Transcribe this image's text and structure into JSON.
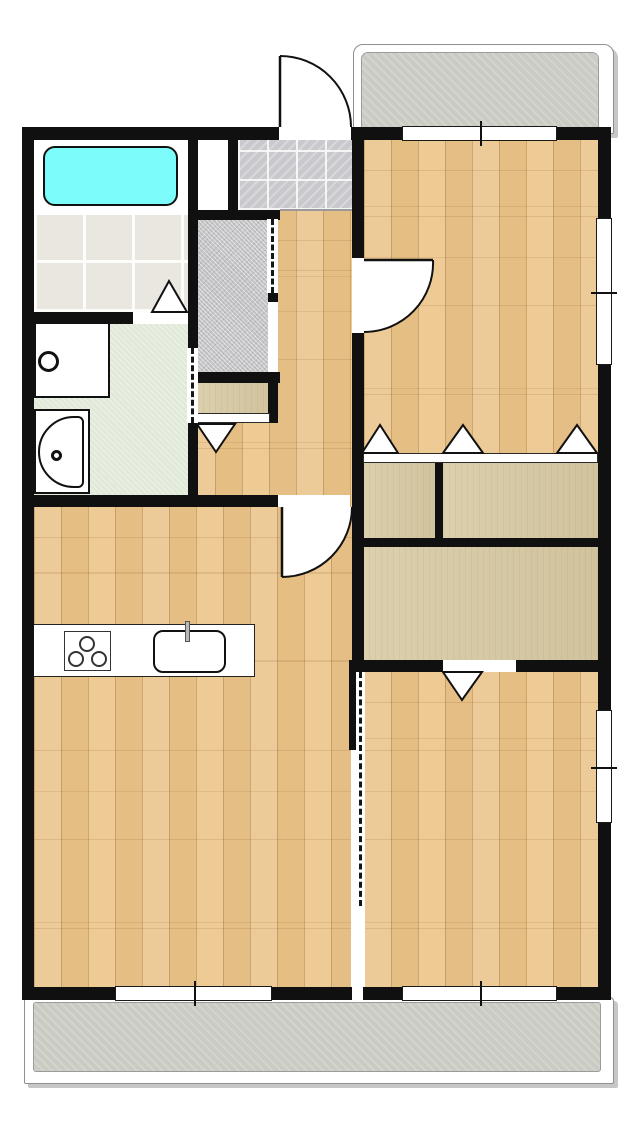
{
  "canvas": {
    "width": 639,
    "height": 1127,
    "background": "#ffffff"
  },
  "palette": {
    "wall": "#101010",
    "wood": "#ebc58c",
    "closet": "#d7c9a2",
    "tileBath": "#e9e7e0",
    "genkan": "#c8c8cd",
    "sic": "#c5c4c7",
    "washroom": "#e1e9d9",
    "balcony": "#caccc3",
    "tub": "#7dfcfc"
  },
  "surfaces": [
    {
      "name": "balcony-north-outer",
      "kind": "balcony-outer",
      "x": 353,
      "y": 44,
      "w": 259,
      "h": 88,
      "r": 10
    },
    {
      "name": "balcony-north-floor",
      "kind": "balcony",
      "x": 362,
      "y": 53,
      "w": 236,
      "h": 75,
      "r": 6
    },
    {
      "name": "balcony-south-outer",
      "kind": "balcony-outer",
      "x": 24,
      "y": 997,
      "w": 588,
      "h": 85,
      "r": 4
    },
    {
      "name": "balcony-south-floor",
      "kind": "balcony",
      "x": 34,
      "y": 1003,
      "w": 566,
      "h": 68,
      "r": 2
    },
    {
      "name": "hallway-floor",
      "kind": "wood",
      "x": 188,
      "y": 210,
      "w": 164,
      "h": 297
    },
    {
      "name": "living-dining-kitchen-floor",
      "kind": "wood",
      "x": 34,
      "y": 507,
      "w": 318,
      "h": 480
    },
    {
      "name": "bedroom-north-floor",
      "kind": "wood",
      "x": 364,
      "y": 140,
      "w": 234,
      "h": 313
    },
    {
      "name": "bedroom-south-floor",
      "kind": "wood",
      "x": 364,
      "y": 672,
      "w": 234,
      "h": 315
    },
    {
      "name": "bathroom-floor",
      "kind": "white",
      "x": 34,
      "y": 140,
      "w": 154,
      "h": 75
    },
    {
      "name": "bathroom-tile-floor",
      "kind": "tile-bath",
      "x": 34,
      "y": 215,
      "w": 154,
      "h": 97
    },
    {
      "name": "utility-void",
      "kind": "white",
      "x": 198,
      "y": 137,
      "w": 30,
      "h": 76
    },
    {
      "name": "entry-tile-floor",
      "kind": "tile-genkan",
      "x": 238,
      "y": 140,
      "w": 114,
      "h": 70
    },
    {
      "name": "shoe-closet-floor",
      "kind": "sic",
      "x": 197,
      "y": 219,
      "w": 71,
      "h": 153
    },
    {
      "name": "hall-closet-shelf",
      "kind": "closet",
      "x": 197,
      "y": 380,
      "w": 73,
      "h": 33
    },
    {
      "name": "washroom-floor",
      "kind": "washroom",
      "x": 34,
      "y": 324,
      "w": 154,
      "h": 171
    },
    {
      "name": "closet-north-left",
      "kind": "closet",
      "x": 363,
      "y": 463,
      "w": 72,
      "h": 75
    },
    {
      "name": "closet-north-right",
      "kind": "closet",
      "x": 443,
      "y": 463,
      "w": 155,
      "h": 75
    },
    {
      "name": "closet-south",
      "kind": "closet",
      "x": 363,
      "y": 547,
      "w": 235,
      "h": 113
    }
  ],
  "fixtures": [
    {
      "name": "bathtub",
      "kind": "bathtub",
      "x": 43,
      "y": 146,
      "w": 135,
      "h": 60
    },
    {
      "name": "washing-machine",
      "kind": "washer",
      "x": 34,
      "y": 322,
      "w": 76,
      "h": 76,
      "porthole": {
        "x": 38,
        "y": 351,
        "d": 21
      }
    },
    {
      "name": "vanity-sink",
      "kind": "vanity",
      "x": 34,
      "y": 409,
      "w": 56,
      "h": 85,
      "basin": {
        "x": 38,
        "y": 416,
        "w": 46,
        "h": 72
      },
      "dot": {
        "x": 51,
        "y": 450,
        "d": 11
      }
    },
    {
      "name": "kitchen-counter",
      "kind": "counter",
      "x": 33,
      "y": 624,
      "w": 222,
      "h": 53
    },
    {
      "name": "stove",
      "kind": "stove",
      "x": 64,
      "y": 631,
      "w": 47,
      "h": 40,
      "burnerD": 16,
      "burners": [
        [
          87,
          644
        ],
        [
          76,
          659
        ],
        [
          99,
          659
        ]
      ]
    },
    {
      "name": "kitchen-sink",
      "kind": "sink",
      "x": 153,
      "y": 630,
      "w": 73,
      "h": 43
    },
    {
      "name": "kitchen-faucet",
      "kind": "faucet",
      "x": 185,
      "y": 621,
      "w": 5,
      "h": 21
    }
  ],
  "walls": [
    {
      "name": "wall-north",
      "x": 22,
      "y": 127,
      "w": 589,
      "h": 13
    },
    {
      "name": "wall-west",
      "x": 22,
      "y": 127,
      "w": 12,
      "h": 873
    },
    {
      "name": "wall-east",
      "x": 598,
      "y": 127,
      "w": 13,
      "h": 873
    },
    {
      "name": "wall-south",
      "x": 22,
      "y": 987,
      "w": 589,
      "h": 13
    },
    {
      "name": "wall-bath-spine",
      "x": 188,
      "y": 127,
      "w": 10,
      "h": 380
    },
    {
      "name": "wall-entry-left",
      "x": 228,
      "y": 127,
      "w": 10,
      "h": 86
    },
    {
      "name": "wall-entry-bottom",
      "x": 188,
      "y": 210,
      "w": 92,
      "h": 10
    },
    {
      "name": "wall-sic-post",
      "x": 268,
      "y": 293,
      "w": 10,
      "h": 9
    },
    {
      "name": "wall-hall-closet-right",
      "x": 268,
      "y": 372,
      "w": 10,
      "h": 51
    },
    {
      "name": "wall-sic-bottom",
      "x": 188,
      "y": 372,
      "w": 92,
      "h": 11
    },
    {
      "name": "wall-bath-washroom",
      "x": 22,
      "y": 312,
      "w": 166,
      "h": 12
    },
    {
      "name": "wall-living-north",
      "x": 22,
      "y": 495,
      "w": 258,
      "h": 12
    },
    {
      "name": "wall-center-spine",
      "x": 352,
      "y": 140,
      "w": 12,
      "h": 520
    },
    {
      "name": "wall-partition-stub",
      "x": 349,
      "y": 660,
      "w": 9,
      "h": 90
    },
    {
      "name": "wall-closet-divider-v",
      "x": 435,
      "y": 463,
      "w": 8,
      "h": 75
    },
    {
      "name": "wall-closet-divider-h",
      "x": 352,
      "y": 538,
      "w": 246,
      "h": 9
    },
    {
      "name": "wall-bedroom-south-north",
      "x": 349,
      "y": 660,
      "w": 249,
      "h": 12
    }
  ],
  "strips": [
    {
      "name": "closet-track-north",
      "x": 363,
      "y": 453,
      "w": 235,
      "h": 10
    },
    {
      "name": "closet-track-hall",
      "x": 192,
      "y": 413,
      "w": 78,
      "h": 10
    }
  ],
  "lines": [
    {
      "name": "entry-step-edge",
      "x": 280,
      "y": 209,
      "w": 72,
      "h": 2
    }
  ],
  "openings": [
    {
      "name": "entry-door-opening",
      "x": 279,
      "y": 127,
      "w": 72,
      "h": 13
    },
    {
      "name": "bedroom-north-door-opening",
      "x": 352,
      "y": 258,
      "w": 12,
      "h": 75
    },
    {
      "name": "living-door-opening",
      "x": 278,
      "y": 495,
      "w": 72,
      "h": 12
    },
    {
      "name": "bedroom-south-closet-opening",
      "x": 443,
      "y": 660,
      "w": 73,
      "h": 12
    },
    {
      "name": "bathroom-door-opening",
      "x": 133,
      "y": 312,
      "w": 55,
      "h": 12
    },
    {
      "name": "shoe-closet-entry-opening",
      "x": 268,
      "y": 302,
      "w": 10,
      "h": 70
    },
    {
      "name": "partition-gap",
      "x": 351,
      "y": 750,
      "w": 14,
      "h": 237
    },
    {
      "name": "partition-wall-gap",
      "x": 352,
      "y": 987,
      "w": 11,
      "h": 13
    }
  ],
  "dashes": [
    {
      "name": "washroom-accordion-door",
      "x": 187,
      "y": 348,
      "w": 11,
      "h": 75
    },
    {
      "name": "shoe-closet-accordion-door",
      "x": 267,
      "y": 219,
      "w": 11,
      "h": 74
    },
    {
      "name": "partition-accordion-track",
      "x": 356,
      "y": 672,
      "w": 9,
      "h": 234
    }
  ],
  "windows": [
    {
      "name": "window-north-bedroom",
      "x": 402,
      "y": 126,
      "w": 155,
      "h": 15,
      "tick": "v"
    },
    {
      "name": "window-east-bedroom-north",
      "x": 596,
      "y": 218,
      "w": 16,
      "h": 147,
      "tick": "h"
    },
    {
      "name": "window-east-bedroom-south",
      "x": 596,
      "y": 710,
      "w": 16,
      "h": 113,
      "tick": "h"
    },
    {
      "name": "window-south-living",
      "x": 115,
      "y": 986,
      "w": 157,
      "h": 15,
      "tick": "v"
    },
    {
      "name": "window-south-bedroom",
      "x": 402,
      "y": 986,
      "w": 155,
      "h": 15,
      "tick": "v"
    }
  ],
  "triangles": [
    {
      "name": "bathroom-folding-door",
      "pts": [
        [
          152,
          312
        ],
        [
          187,
          312
        ],
        [
          169,
          281
        ]
      ]
    },
    {
      "name": "hall-closet-folding-door",
      "pts": [
        [
          197,
          424
        ],
        [
          235,
          424
        ],
        [
          216,
          452
        ]
      ]
    },
    {
      "name": "closet-north-door-left",
      "pts": [
        [
          362,
          453
        ],
        [
          398,
          453
        ],
        [
          380,
          425
        ]
      ]
    },
    {
      "name": "closet-north-door-mid",
      "pts": [
        [
          443,
          453
        ],
        [
          483,
          453
        ],
        [
          463,
          425
        ]
      ]
    },
    {
      "name": "closet-north-door-right",
      "pts": [
        [
          557,
          453
        ],
        [
          597,
          453
        ],
        [
          577,
          425
        ]
      ]
    },
    {
      "name": "closet-south-folding-door",
      "pts": [
        [
          443,
          672
        ],
        [
          482,
          672
        ],
        [
          462,
          700
        ]
      ]
    }
  ],
  "doors": [
    {
      "name": "entry-swing-door",
      "hinge": [
        280,
        127
      ],
      "tip": [
        280,
        56
      ],
      "end": [
        351,
        127
      ],
      "sweep": 1
    },
    {
      "name": "bedroom-north-swing-door",
      "hinge": [
        364,
        260
      ],
      "tip": [
        433,
        260
      ],
      "end": [
        364,
        332
      ],
      "sweep": 1
    },
    {
      "name": "living-swing-door",
      "hinge": [
        282,
        507
      ],
      "tip": [
        282,
        577
      ],
      "end": [
        352,
        507
      ],
      "sweep": 0
    }
  ]
}
